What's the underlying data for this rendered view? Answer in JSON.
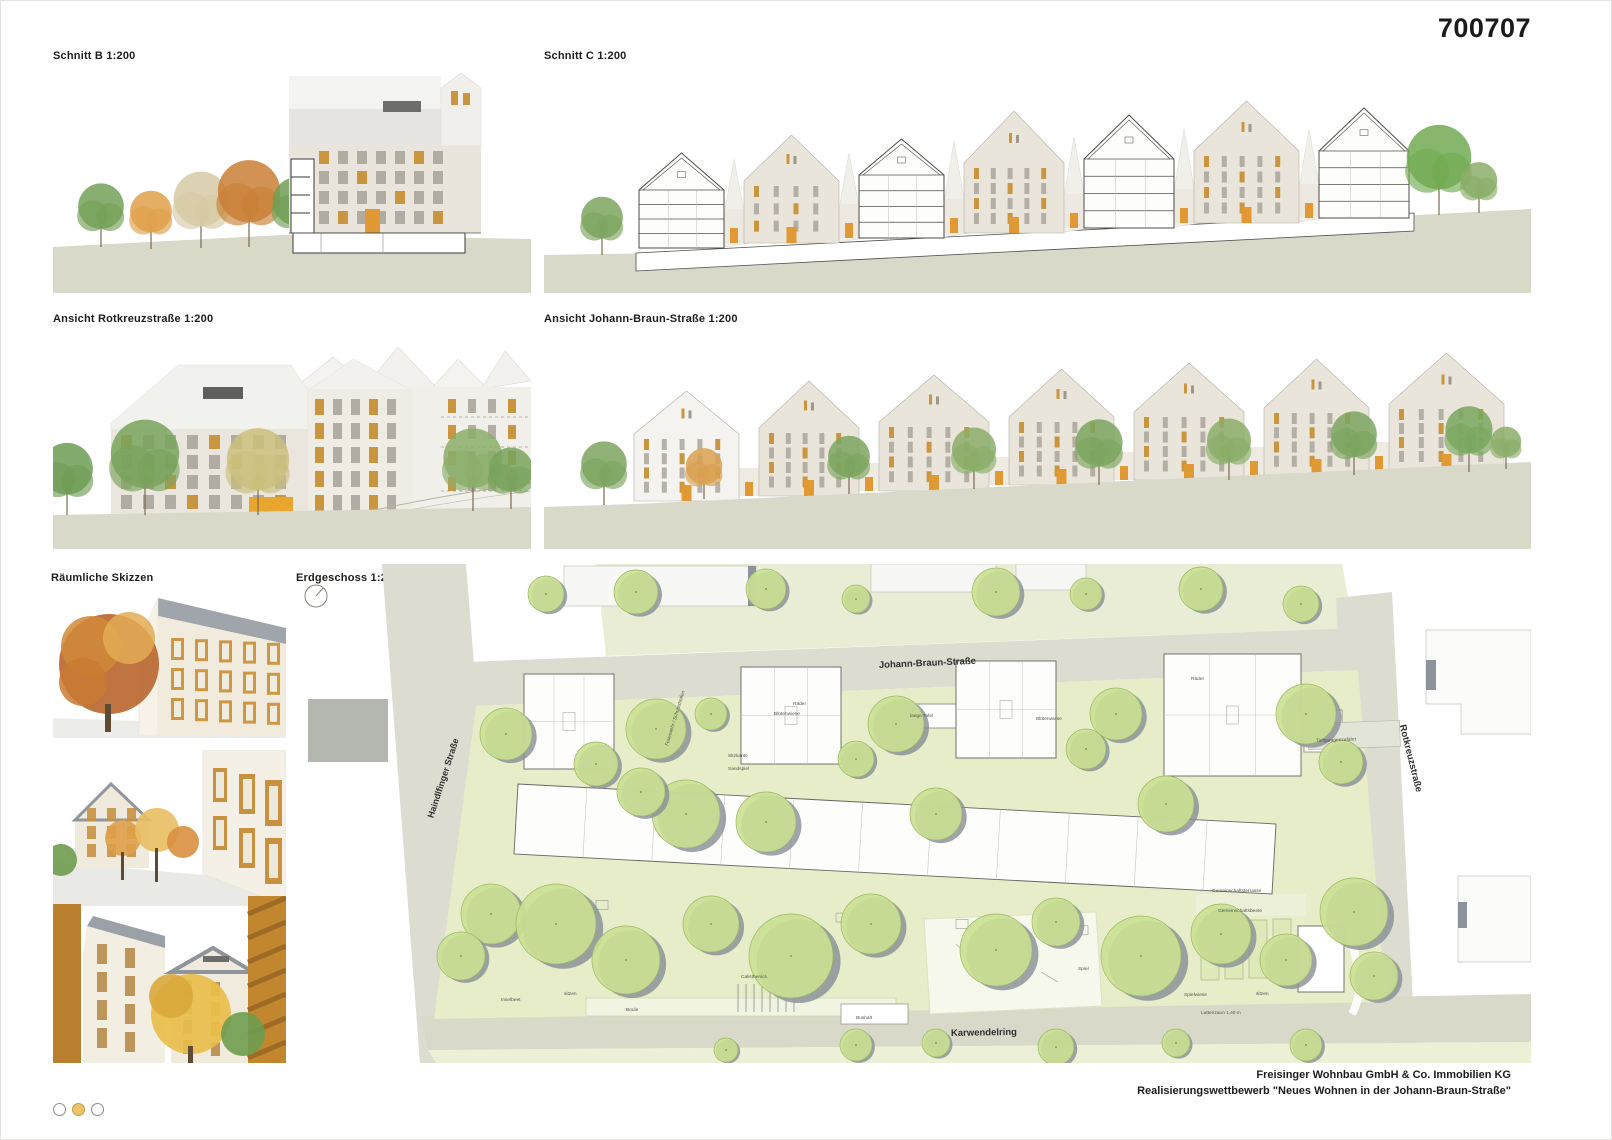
{
  "board": {
    "number": "700707"
  },
  "panels": {
    "schnitt_b": {
      "title": "Schnitt B 1:200"
    },
    "schnitt_c": {
      "title": "Schnitt C 1:200"
    },
    "ansicht_rotkreuz": {
      "title": "Ansicht Rotkreuzstraße 1:200"
    },
    "ansicht_johann": {
      "title": "Ansicht Johann-Braun-Straße 1:200"
    },
    "skizzen": {
      "title": "Räumliche Skizzen"
    },
    "erdgeschoss": {
      "title": "Erdgeschoss 1:200"
    }
  },
  "plan": {
    "streets": {
      "johann_braun": "Johann-Braun-Straße",
      "haindlfinger": "Haindlfinger Straße",
      "rotkreuz": "Rotkreuzstraße",
      "karwendelring": "Karwendelring"
    },
    "labels": {
      "raeder": "Räder",
      "bluetenwiese": "Blütenwiese",
      "lange_tafel": "lange Tafel",
      "sitzkante": "Sitzkante",
      "sandspiel": "Sandspiel",
      "feuerwehr": "Feuerwehr / Schutzstreifen",
      "spiel": "Spiel",
      "spielwiese": "Spielwiese",
      "sitzen": "sitzen",
      "boule": "Boule",
      "calisthenics": "Calisthenics",
      "inselbeet": "Inselbeet",
      "bushalt": "Bushalt",
      "gemeinschaftsterrasse": "Gemeinschaftsterrasse",
      "gemeinschaftsbeete": "Gemeinschaftsbeete",
      "tiefgaragenzufahrt": "Tiefgaragenzufahrt",
      "lattenzaun": "Lattenzaun 1,40 m"
    }
  },
  "footer": {
    "client": "Freisinger Wohnbau GmbH & Co. Immobilien KG",
    "competition": "Realisierungswettbewerb \"Neues Wohnen in der Johann-Braun-Straße\""
  },
  "pagination": {
    "total": 3,
    "active_index": 1
  },
  "colors": {
    "accent_orange": "#E19A33",
    "wood_orange": "#C9953F",
    "ground": "#D8D9C9",
    "street": "#DCDDD0",
    "lawn": "#E7ECC9",
    "tree_green": "#CBE092",
    "facade": "#EAE5DB",
    "roof": "#F0F0ED"
  }
}
